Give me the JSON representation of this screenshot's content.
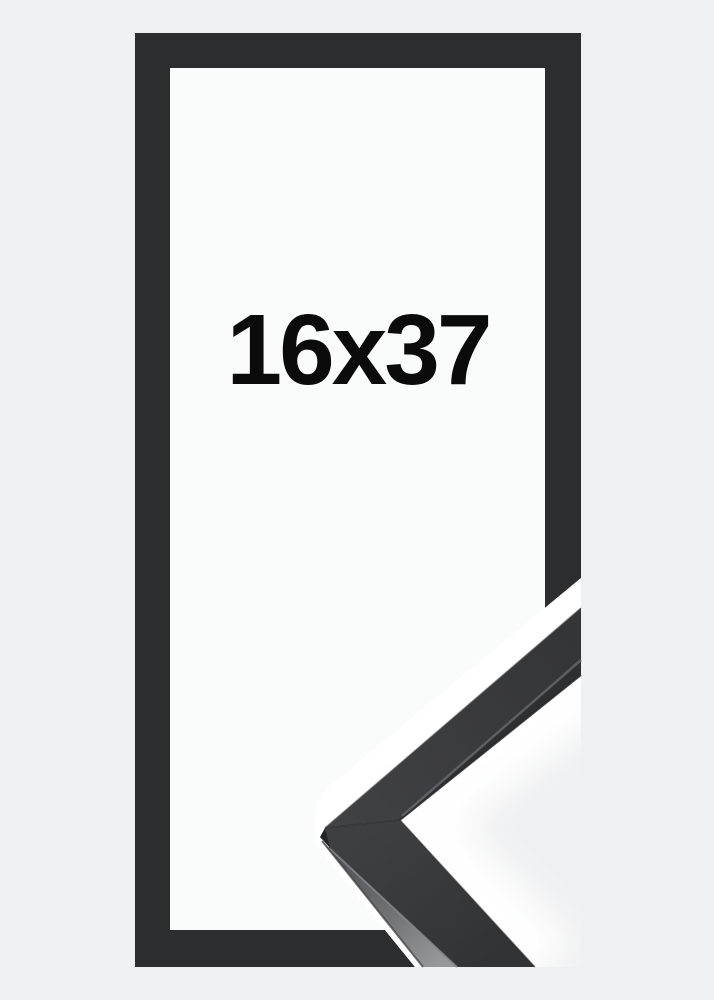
{
  "product": {
    "size_label": "16x37"
  },
  "colors": {
    "background": "#eff0f1",
    "frame": "#2c2d2f",
    "mat": "#fafbfb",
    "separator": "#ffffff",
    "label_text": "#0b0b0c",
    "detail_face_dark": "#333436",
    "detail_face_light": "#414244",
    "detail_side_face": "#96989a"
  }
}
